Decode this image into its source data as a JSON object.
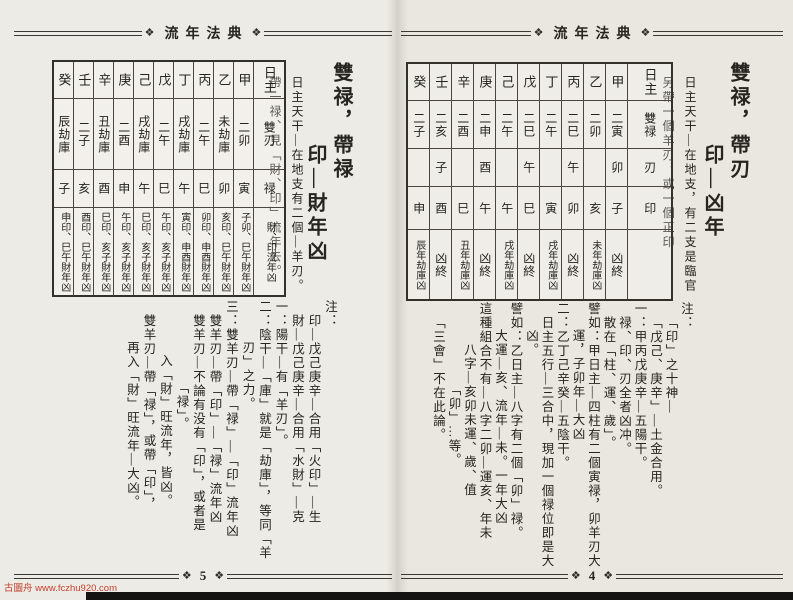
{
  "ornament": "❖",
  "watermark": "古圖舟 www.fczhu920.com",
  "pages": [
    {
      "page_number": "5",
      "header_title": "流年法典",
      "headline_main": "雙禄，帶禄",
      "headline_sub": "印—財年凶",
      "intro": [
        {
          "t": "日主天干—在地支有二個—羊刃。",
          "i": 0
        },
        {
          "t": "帶一禄、見「財、印」流年去。",
          "i": 0
        }
      ],
      "table": {
        "row_labels": [
          "日主",
          "雙刃",
          "禄",
          "財、印流年凶"
        ],
        "columns": [
          [
            "癸",
            "辰劫庫",
            "子",
            "申印、巳午財年凶"
          ],
          [
            "壬",
            "二子",
            "亥",
            "酉印、巳午財年凶"
          ],
          [
            "辛",
            "丑劫庫",
            "酉",
            "巳印、亥子財年凶"
          ],
          [
            "庚",
            "二酉",
            "申",
            "午印、亥子財年凶"
          ],
          [
            "己",
            "戌劫庫",
            "午",
            "巳印、亥子財年凶"
          ],
          [
            "戊",
            "二午",
            "巳",
            "午印、亥子財年凶"
          ],
          [
            "丁",
            "戌劫庫",
            "午",
            "寅印、申酉財年凶"
          ],
          [
            "丙",
            "二午",
            "巳",
            "卯印、申酉財年凶"
          ],
          [
            "乙",
            "未劫庫",
            "卯",
            "亥印、巳午財年凶"
          ],
          [
            "甲",
            "二卯",
            "寅",
            "子卯、巳午財年凶"
          ],
          [
            "日主",
            "雙刃",
            "禄",
            "財、印流年凶"
          ]
        ]
      },
      "notes": [
        {
          "t": "注：",
          "i": 0
        },
        {
          "t": "印—戊己庚辛—合用「火印」—生",
          "i": 1
        },
        {
          "t": "財—戊己庚辛—合用「水財」—克",
          "i": 1
        },
        {
          "t": "一：陽干—有「羊刃」。",
          "i": 0
        },
        {
          "t": "二：陰干—「庫」就是「劫庫」，等同「羊",
          "i": 0
        },
        {
          "t": "刃」之力。",
          "i": 3
        },
        {
          "t": "三：雙羊刃—帶「禄」—「印」流年凶",
          "i": 0
        },
        {
          "t": "雙羊刃—帶「印」—「禄」流年凶",
          "i": 1
        },
        {
          "t": "雙羊刃—不論有没有「印」，或者是",
          "i": 1
        },
        {
          "t": "「禄」。",
          "i": 6
        },
        {
          "t": "入「財」旺流年，皆凶。",
          "i": 4
        },
        {
          "t": "雙羊刃—帶「禄」，或帶「印」，",
          "i": 1
        },
        {
          "t": "再入「財」旺流年—大凶。",
          "i": 3
        }
      ]
    },
    {
      "page_number": "4",
      "header_title": "流年法典",
      "headline_main": "雙禄，帶刃",
      "headline_sub": "印—凶年",
      "intro": [
        {
          "t": "日主天干—在地支，有二支是臨官",
          "i": 0
        },
        {
          "t": "另帶一個羊刃，或一個正印",
          "i": 0
        }
      ],
      "table": {
        "row_labels": [
          "日主",
          "雙禄",
          "刃",
          "印",
          ""
        ],
        "columns": [
          [
            "癸",
            "二子",
            "",
            "申",
            "辰年劫庫凶"
          ],
          [
            "壬",
            "二亥",
            "子",
            "酉",
            "凶終"
          ],
          [
            "辛",
            "二酉",
            "",
            "巳",
            "丑年劫庫凶"
          ],
          [
            "庚",
            "二申",
            "酉",
            "午",
            "凶終"
          ],
          [
            "己",
            "二午",
            "",
            "午",
            "戌年劫庫凶"
          ],
          [
            "戊",
            "二巳",
            "午",
            "巳",
            "凶終"
          ],
          [
            "丁",
            "二午",
            "",
            "寅",
            "戌年劫庫凶"
          ],
          [
            "丙",
            "二巳",
            "午",
            "卯",
            "凶終"
          ],
          [
            "乙",
            "二卯",
            "",
            "亥",
            "未年劫庫凶"
          ],
          [
            "甲",
            "二寅",
            "卯",
            "子",
            "凶終"
          ],
          [
            "日主",
            "雙禄",
            "刃",
            "印",
            ""
          ]
        ]
      },
      "notes": [
        {
          "t": "注：",
          "i": 0
        },
        {
          "t": "「印」之十神—",
          "i": 1
        },
        {
          "t": "「戊己、庚辛」—土金合用。",
          "i": 1
        },
        {
          "t": "一：甲丙戊庚辛—五陽干。",
          "i": 0
        },
        {
          "t": "禄、印、刃全者凶冲。",
          "i": 1
        },
        {
          "t": "散在「柱、運、歲」。",
          "i": 1
        },
        {
          "t": "譬如：甲日主—四柱有二個寅禄，卯羊刃大",
          "i": 0
        },
        {
          "t": "運，子卯年—大凶",
          "i": 2
        },
        {
          "t": "二：乙丁己辛癸—五陰干。",
          "i": 0
        },
        {
          "t": "日主五行—三合中，現加一個禄位即是大",
          "i": 1
        },
        {
          "t": "凶。",
          "i": 2
        },
        {
          "t": "譬如：乙日主—八字有二個「卯」禄。",
          "i": 0
        },
        {
          "t": "大運—亥、流年—未。一年大凶",
          "i": 2
        },
        {
          "t": "這種組合不有—八字二卯—運亥、年未",
          "i": 0
        },
        {
          "t": "八字—亥卯未運、歲、值",
          "i": 3
        },
        {
          "t": "「卯」…等。",
          "i": 6
        },
        {
          "t": "「三會」不在此論。",
          "i": 1
        }
      ]
    }
  ]
}
